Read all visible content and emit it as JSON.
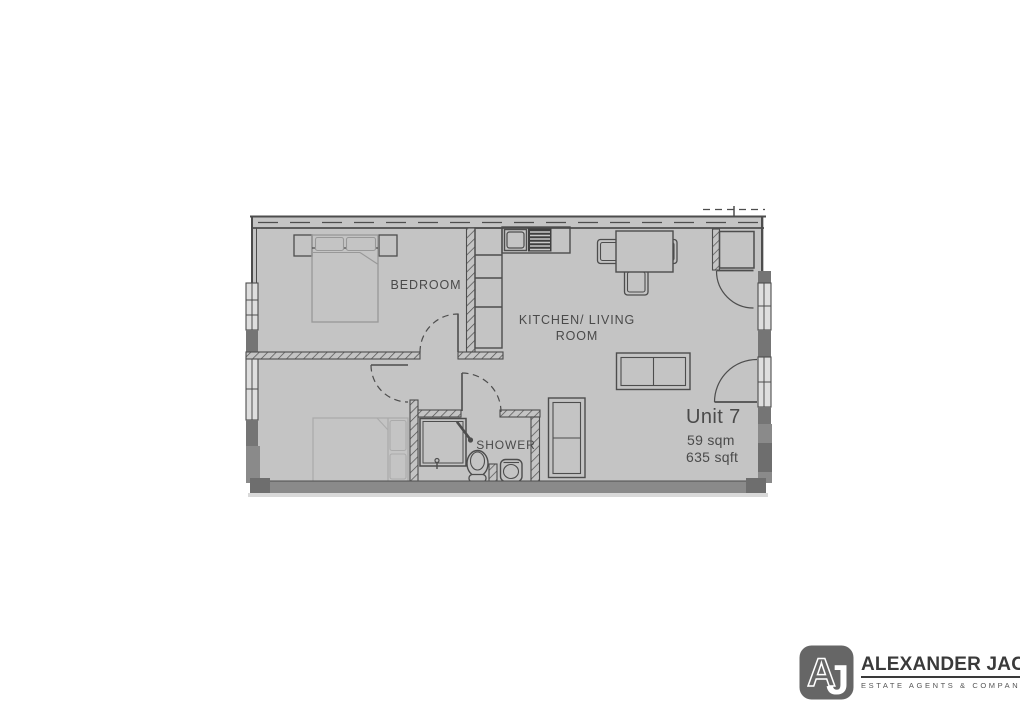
{
  "plan": {
    "unit_name": "Unit 7",
    "unit_area_sqm": "59 sqm",
    "unit_area_sqft": "635 sqft",
    "rooms": {
      "bedroom": "BEDROOM",
      "kitchen_living_line1": "KITCHEN/ LIVING",
      "kitchen_living_line2": "ROOM",
      "shower": "SHOWER"
    }
  },
  "logo": {
    "monogram_a": "A",
    "monogram_j": "J",
    "name": "ALEXANDER JACOB",
    "tagline": "ESTATE AGENTS & COMPANY"
  },
  "colors": {
    "floor": "#c4c4c4",
    "line": "#4d4d4d",
    "text": "#4a4a4a",
    "wall_dark": "#757575",
    "wall_medium": "#8a8a8a",
    "wall_darker": "#6e6e6e",
    "window": "#dedede",
    "hob_dark": "#3f3f3f",
    "furniture_light": "#989898",
    "furniture_faint": "#ababab",
    "shadow": "#d9d9d9",
    "logo_box": "#666666",
    "logo_text": "#3a3a3a",
    "logo_tagline": "#555555"
  }
}
